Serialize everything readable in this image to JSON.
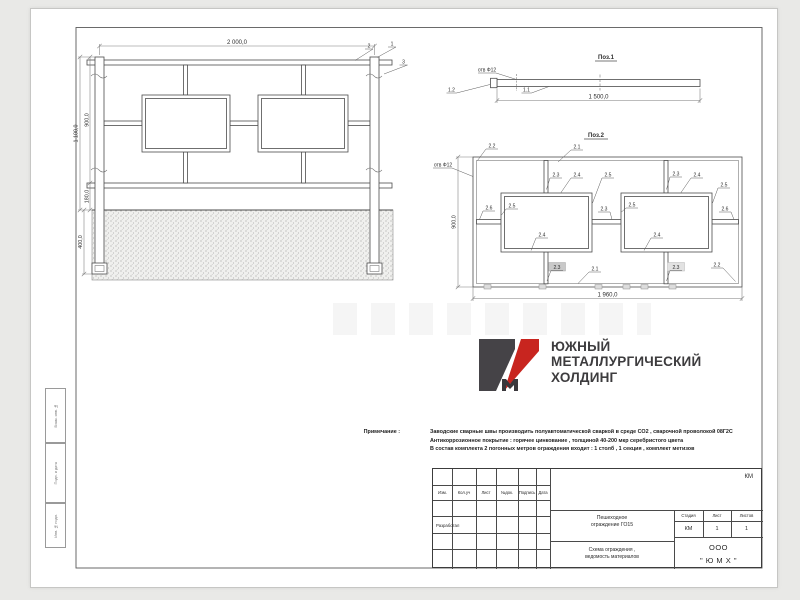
{
  "colors": {
    "accent_red": "#c8251f",
    "logo_grey": "#454347",
    "line": "#4c4c4c"
  },
  "elevation": {
    "dim_width": "2 000,0",
    "dim_total_height": "1 100,0",
    "dim_section_height": "900,0",
    "dim_rail_offset": "180,0",
    "dim_embed_depth": "400,0",
    "callout_1": "1",
    "callout_2": "2",
    "callout_3": "3"
  },
  "pos1": {
    "title": "Поз.1",
    "hole_label": "отв Ф12",
    "callout_1_1": "1.1",
    "callout_1_2": "1.2",
    "dim_length": "1 500,0"
  },
  "pos2": {
    "title": "Поз.2",
    "hole_label": "отв Ф12",
    "dim_height": "900,0",
    "dim_width": "1 960,0",
    "c21": "2.1",
    "c22": "2.2",
    "c23": "2.3",
    "c24": "2.4",
    "c25": "2.5",
    "c26": "2.6"
  },
  "logo": {
    "line1": "ЮЖНЫЙ",
    "line2": "МЕТАЛЛУРГИЧЕСКИЙ",
    "line3": "ХОЛДИНГ"
  },
  "notes": {
    "label": "Примечание :",
    "line1": "Заводские сварные швы производить полуавтоматической сваркой в среде СО2 , сварочной проволокой 08Г2С",
    "line2": "Антикоррозионное покрытие : горячее цинкование , толщиной 40-200 мкр серебристого цвета",
    "line3": "В состав комплекта 2 погонных метров ограждения входит : 1 столб , 1 секция , комплект метизов"
  },
  "titleblock": {
    "doc_code": "КМ",
    "col_izm": "Изм.",
    "col_koluch": "Кол.уч",
    "col_list": "Лист",
    "col_ndok": "№док.",
    "col_podpis": "Подпись",
    "col_data": "Дата",
    "row_razrabotal": "Разработал",
    "doc_name_line1": "Пешеходное",
    "doc_name_line2": "ограждение ГО15",
    "sheet_title_line1": "Схема ограждения ,",
    "sheet_title_line2": "ведомость материалов",
    "stage_header": "Стадия",
    "sheet_header": "Лист",
    "sheets_header": "Листов",
    "stage_value": "КМ",
    "sheet_value": "1",
    "sheets_value": "1",
    "company_line1": "ООО",
    "company_line2": "\" Ю М Х \""
  },
  "margin_stamp": {
    "cell_top": "Взам. инв. №",
    "cell_middle": "Подп. и дата",
    "cell_bottom": "Инв. № подл."
  }
}
